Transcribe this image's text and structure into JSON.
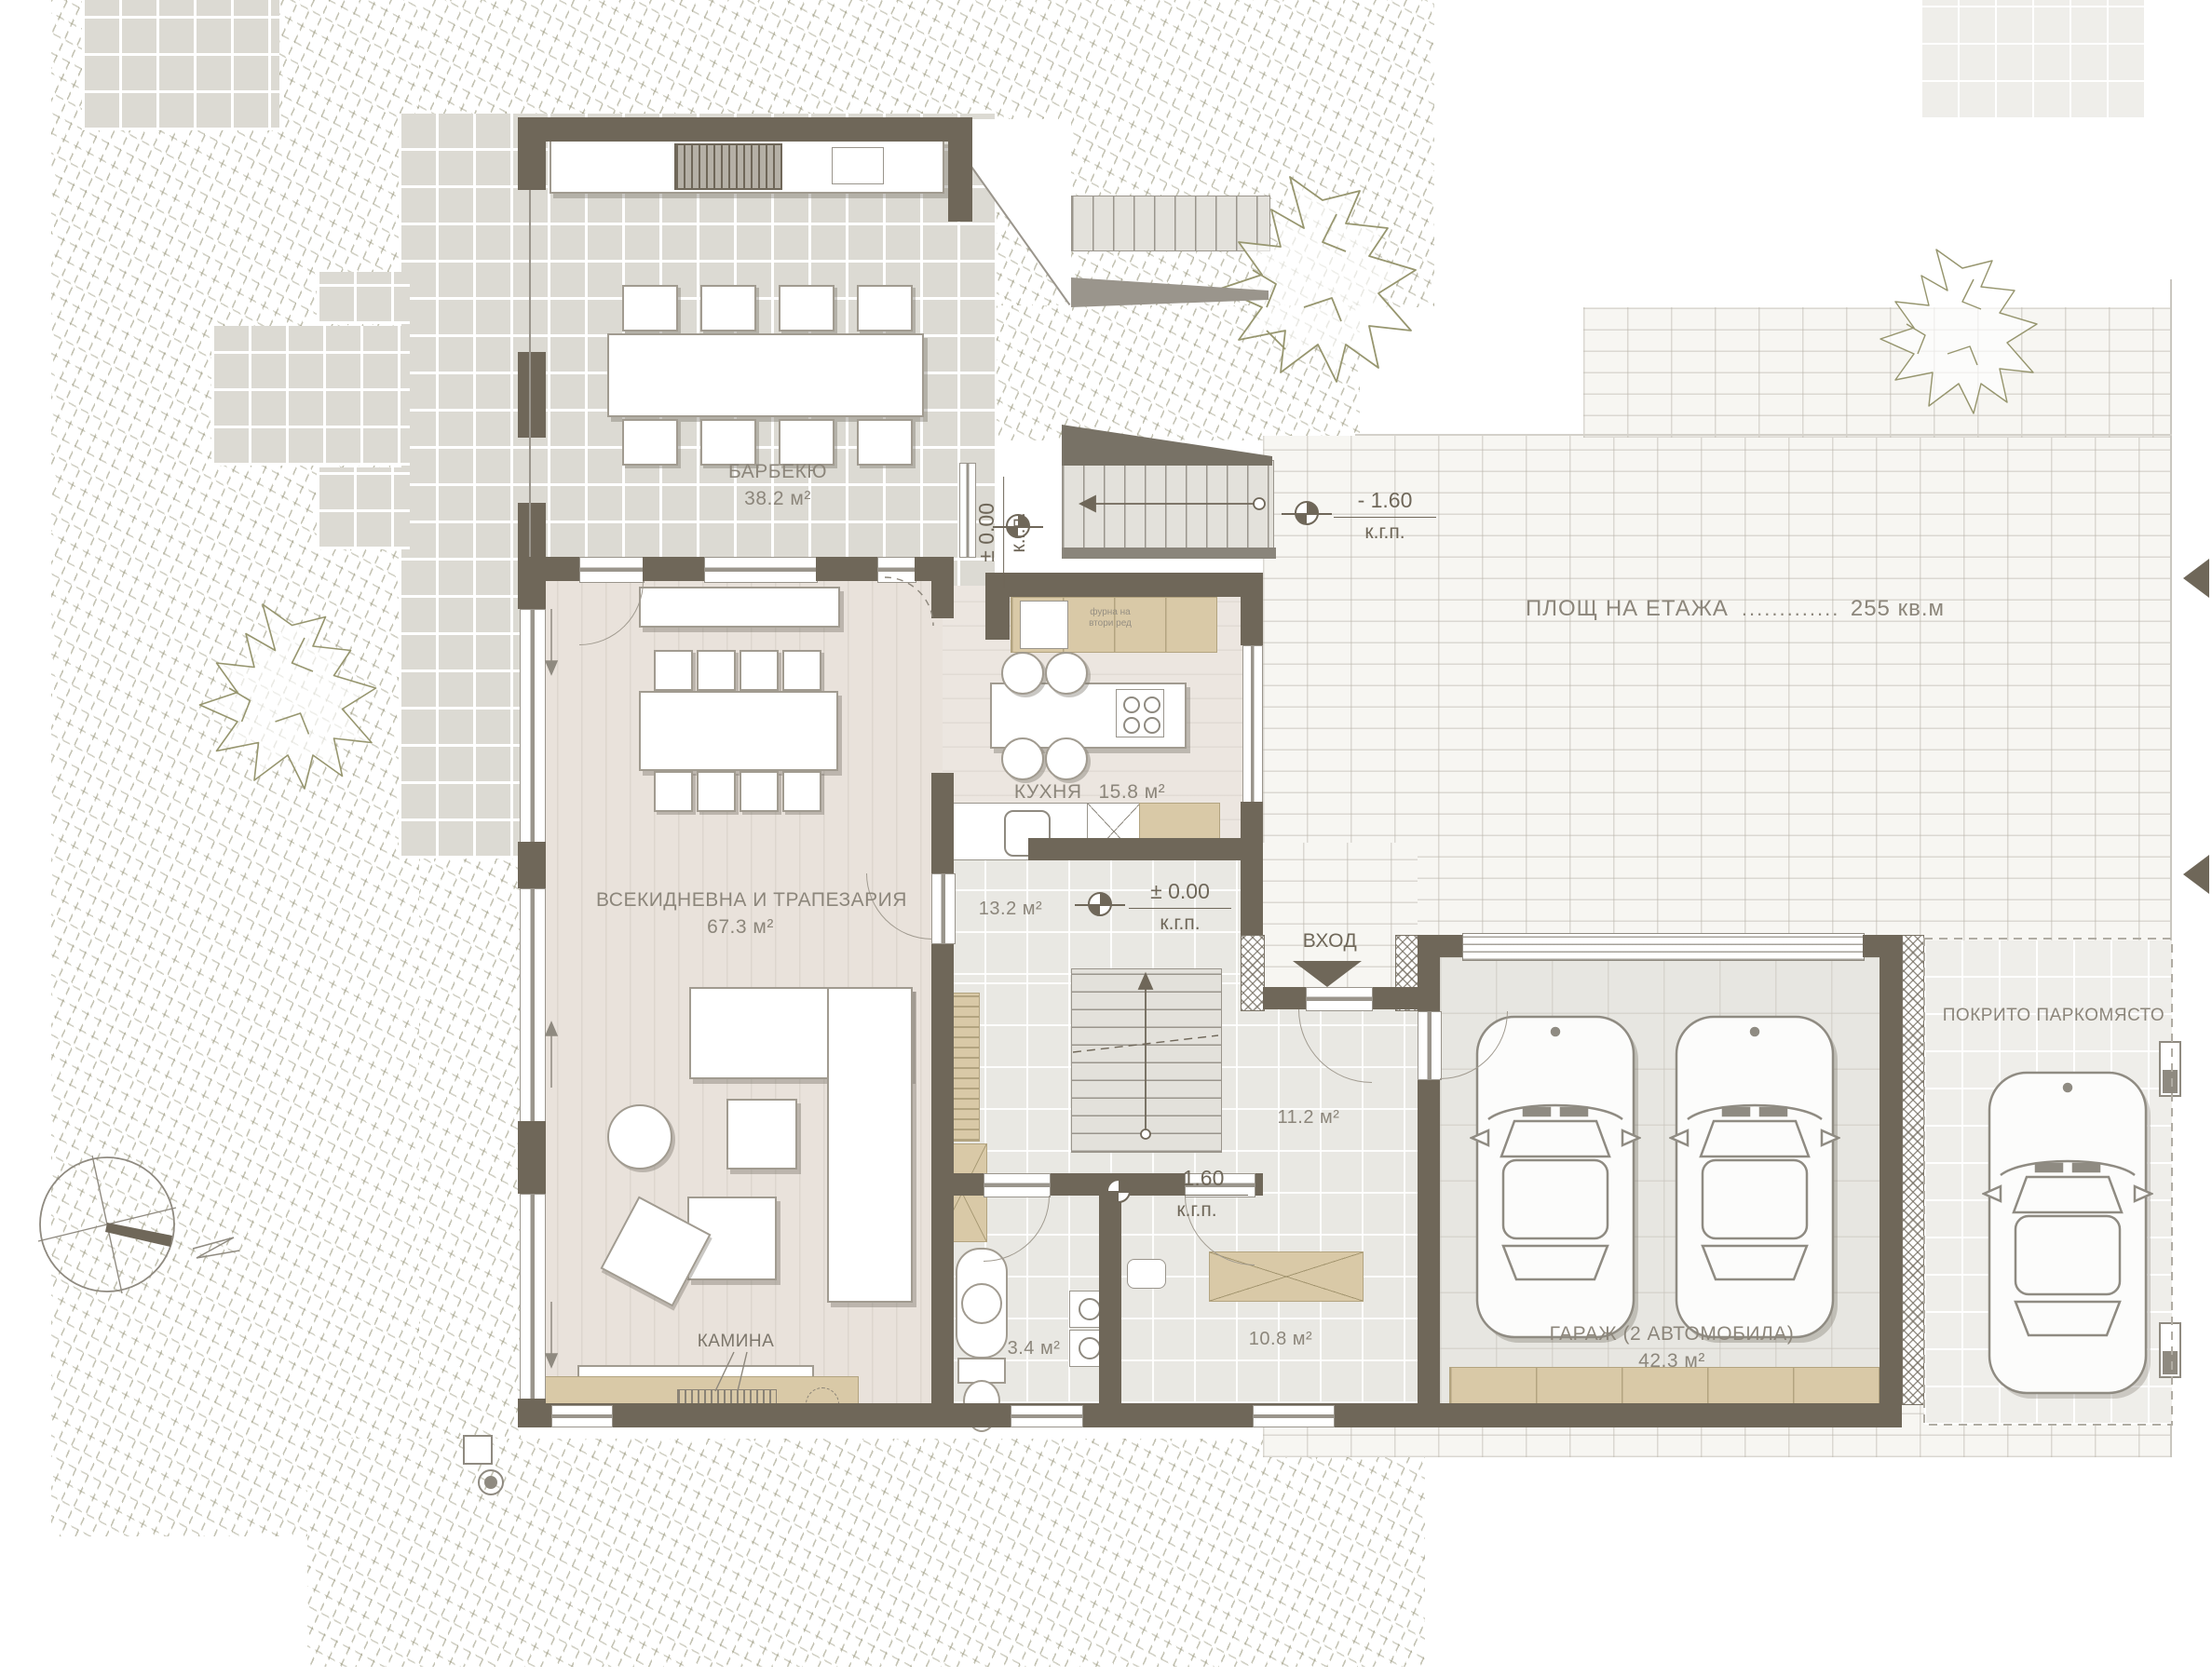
{
  "rooms": {
    "barbecue": {
      "name": "БАРБЕКЮ",
      "area": "38.2 м²"
    },
    "living": {
      "name": "ВСЕКИДНЕВНА И ТРАПЕЗАРИЯ",
      "area": "67.3 м²"
    },
    "kitchen": {
      "name": "КУХНЯ",
      "area": "15.8 м²"
    },
    "entry_hall": {
      "area": "13.2 м²"
    },
    "inner_hall": {
      "area": "11.2 м²"
    },
    "wc": {
      "area": "3.4 м²"
    },
    "utility": {
      "area": "10.8 м²"
    },
    "garage": {
      "name": "ГАРАЖ  (2 АВТОМОБИЛА)",
      "area": "42.3 м²"
    },
    "carport": {
      "name": "ПОКРИТО ПАРКОМЯСТО"
    }
  },
  "annotations": {
    "entrance": "ВХОД",
    "fireplace": "КАМИНА",
    "kitchen_note_line1": "фурна на",
    "kitchen_note_line2": "втори ред",
    "floor_area_label": "ПЛОЩ НА ЕТАЖА",
    "floor_area_leader": ".....................................",
    "floor_area_value": "255 кв.м",
    "compass_north": "N"
  },
  "levels": {
    "terrace": {
      "value": "± 0.00",
      "datum": "к.г.п."
    },
    "yard": {
      "value": "- 1.60",
      "datum": "к.г.п."
    },
    "entry": {
      "value": "± 0.00",
      "datum": "к.г.п."
    },
    "stair_hall": {
      "value": "- 1.60",
      "datum": "к.г.п."
    }
  },
  "colors": {
    "wall": "#6f6759",
    "cabinet": "#d9c9a7",
    "terrace_tile": "#dcdad3",
    "label_text": "#8c867b"
  }
}
